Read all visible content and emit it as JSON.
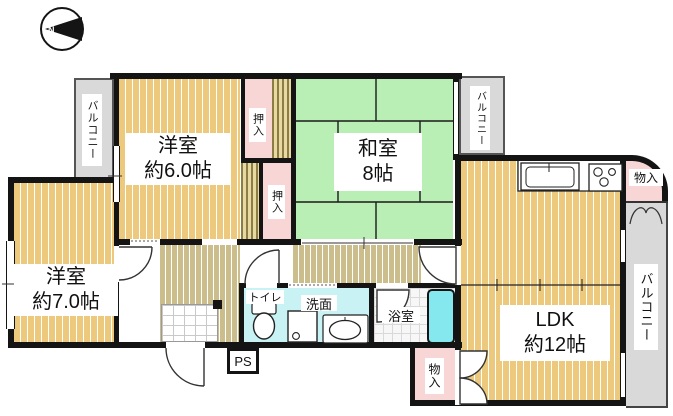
{
  "plan": {
    "compass_label": "N",
    "rooms": {
      "western1": {
        "name": "洋室",
        "size": "約6.0帖"
      },
      "japanese": {
        "name": "和室",
        "size": "8帖"
      },
      "western2": {
        "name": "洋室",
        "size": "約7.0帖"
      },
      "ldk": {
        "name": "LDK",
        "size": "約12帖"
      }
    },
    "labels": {
      "balcony": "バルコニー",
      "closet": "押入",
      "storage": "物入",
      "toilet": "トイレ",
      "washroom": "洗面",
      "bathroom": "浴室",
      "pipe_space": "PS"
    },
    "colors": {
      "wall": "#141414",
      "wood_floor": "#ecc97d",
      "tatami_green": "#b9eeb5",
      "closet_pink": "#f9d6d6",
      "wet_area_cyan": "#c9f2f5",
      "bathtub_cyan": "#85e8ee",
      "balcony_grey": "#d9d9d9",
      "hall_floor": "#cbbd8c"
    }
  }
}
